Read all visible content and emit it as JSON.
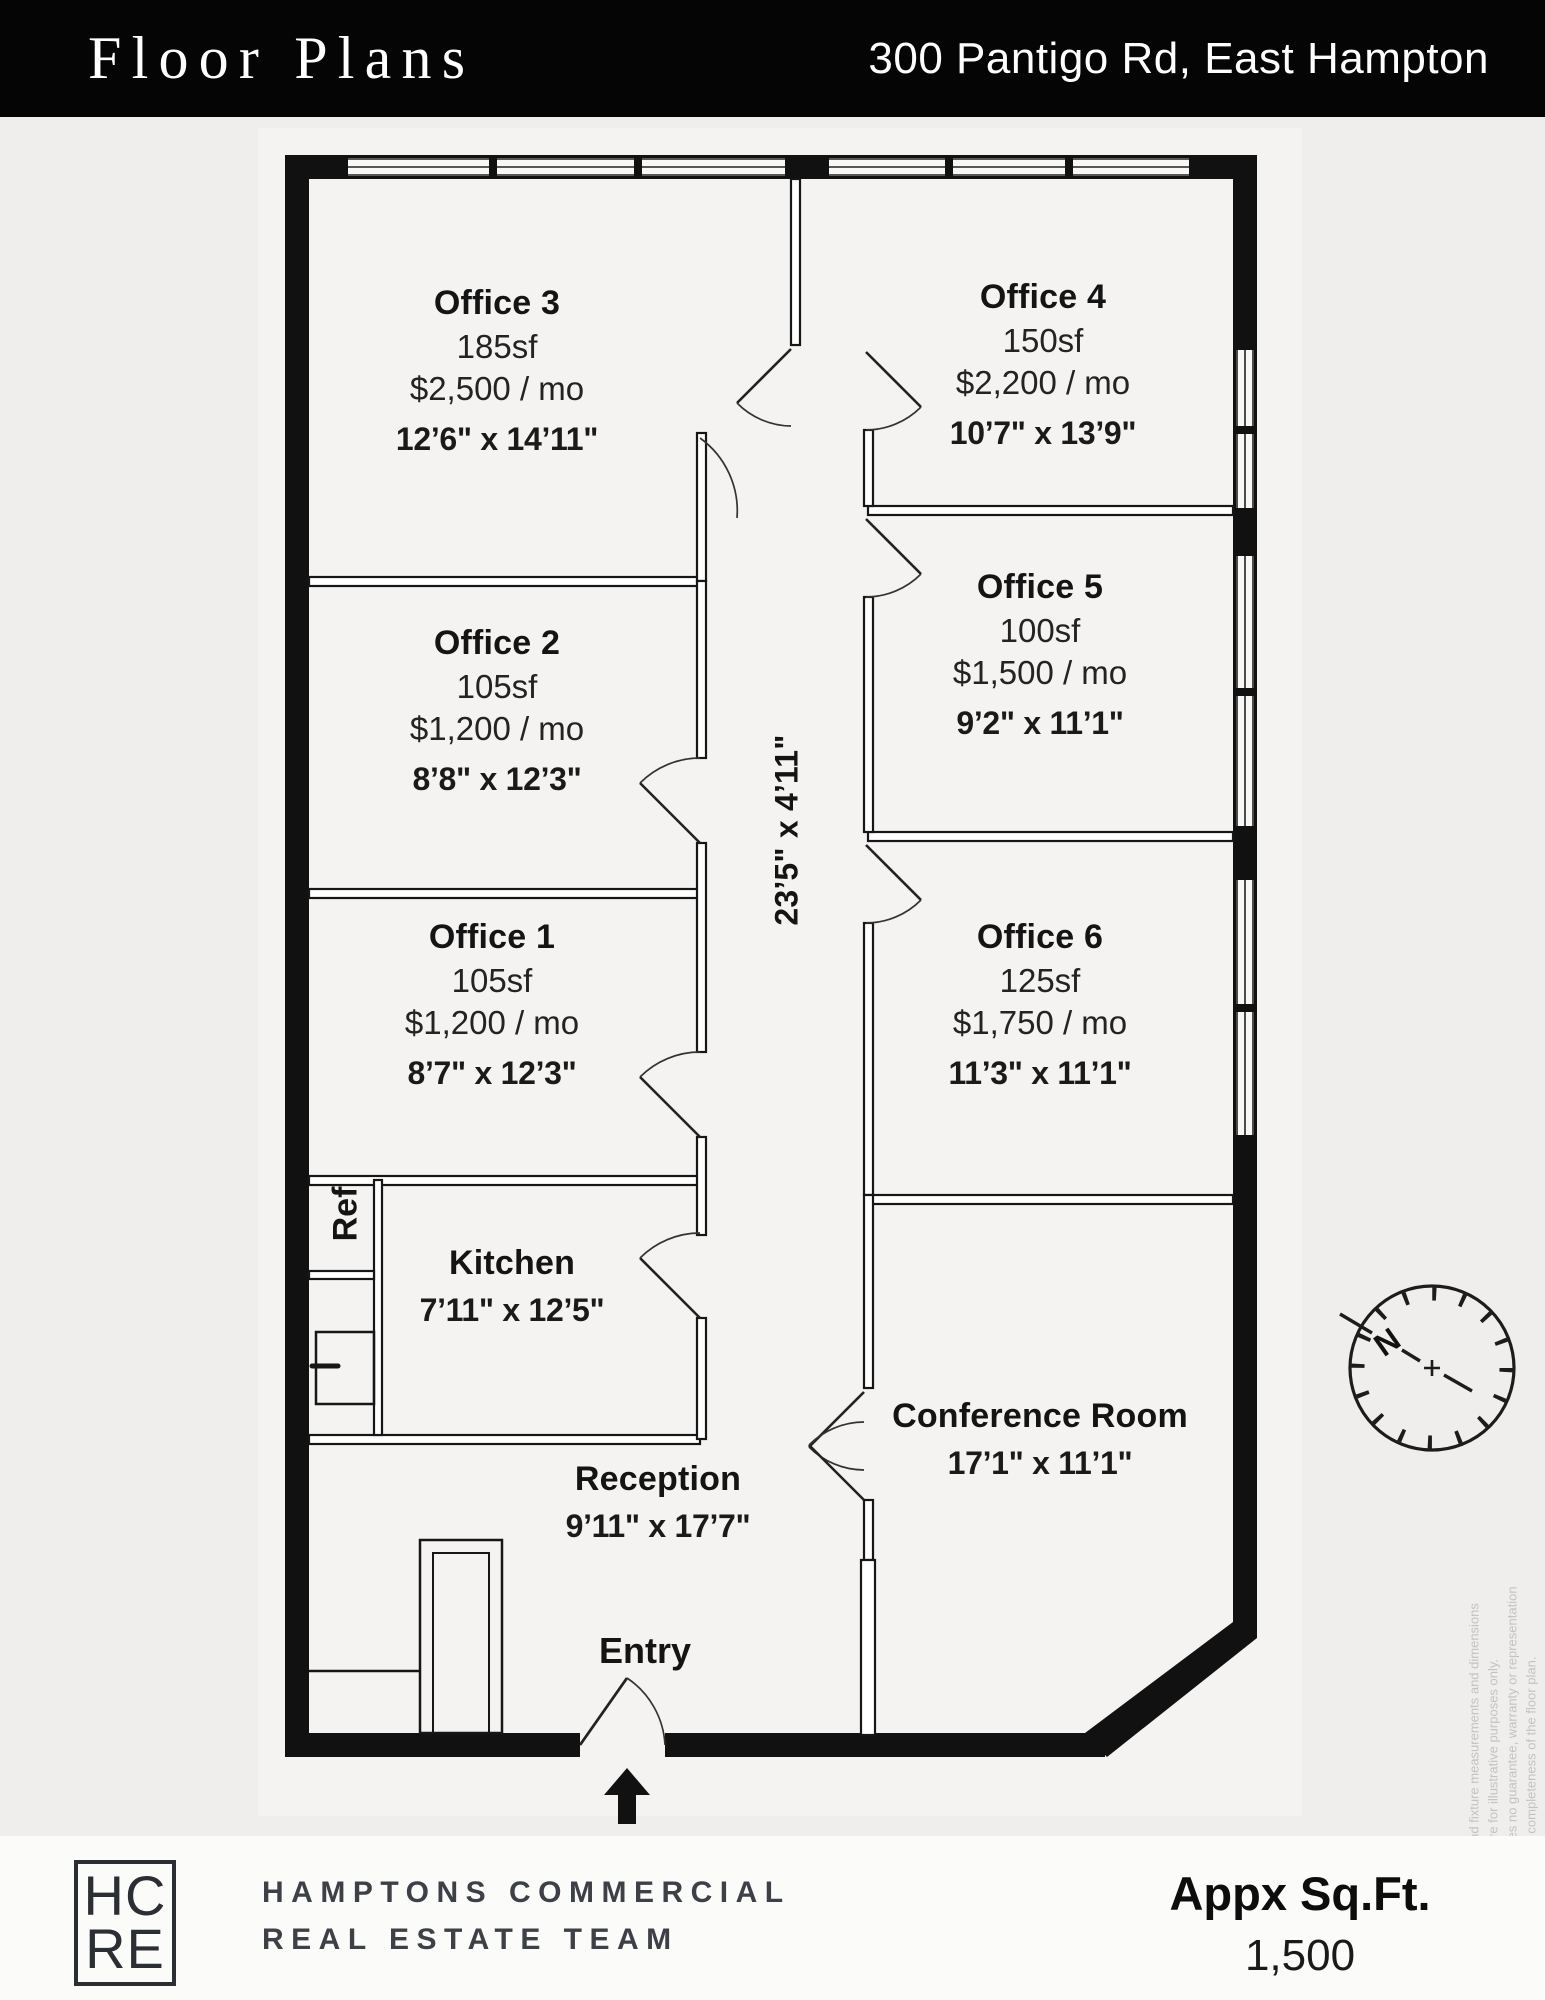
{
  "header": {
    "title": "Floor Plans",
    "address": "300 Pantigo Rd, East Hampton"
  },
  "rooms": [
    {
      "name": "Office 3",
      "area": "185sf",
      "price": "$2,500 / mo",
      "dims": "12’6\" x 14’11\""
    },
    {
      "name": "Office 4",
      "area": "150sf",
      "price": "$2,200 / mo",
      "dims": "10’7\" x 13’9\""
    },
    {
      "name": "Office 2",
      "area": "105sf",
      "price": "$1,200 / mo",
      "dims": "8’8\" x 12’3\""
    },
    {
      "name": "Office 5",
      "area": "100sf",
      "price": "$1,500 / mo",
      "dims": "9’2\" x 11’1\""
    },
    {
      "name": "Office 1",
      "area": "105sf",
      "price": "$1,200 / mo",
      "dims": "8’7\" x 12’3\""
    },
    {
      "name": "Office 6",
      "area": "125sf",
      "price": "$1,750 / mo",
      "dims": "11’3\" x 11’1\""
    },
    {
      "name": "Kitchen",
      "dims": "7’11\" x 12’5\""
    },
    {
      "name": "Reception",
      "dims": "9’11\" x 17’7\""
    },
    {
      "name": "Conference Room",
      "dims": "17’1\" x 11’1\""
    }
  ],
  "labels": {
    "entry": "Entry",
    "ref": "Ref",
    "hallway_dims": "23’5\" x 4’11\"",
    "north": "N"
  },
  "disclaimer": {
    "lines": [
      "Floor plan, furniture, and fixture measurements and dimensions",
      "are approximate and are for illustrative purposes only.",
      "The representative gives no guarantee, warranty or representation",
      "as to the accuracy and completeness of the floor plan."
    ]
  },
  "footer": {
    "logo_line1": "HC",
    "logo_line2": "RE",
    "team_line1": "HAMPTONS COMMERCIAL",
    "team_line2": "REAL ESTATE TEAM",
    "sqft_label": "Appx Sq.Ft.",
    "sqft_value": "1,500"
  },
  "colors": {
    "header_bg": "#050505",
    "wall": "#111111",
    "page_bg": "#efeeec",
    "plan_bg": "#f4f3f1",
    "footer_bg": "#fbfbfa",
    "disclaimer_text": "#c4c2c0"
  }
}
